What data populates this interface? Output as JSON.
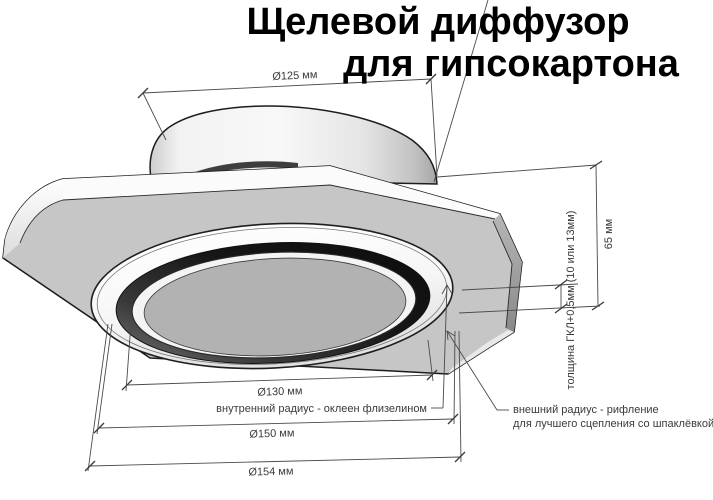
{
  "title": {
    "line1": "Щелевой диффузор",
    "line2": "для гипсокартона"
  },
  "dimensions": {
    "duct_diameter": "Ø125 мм",
    "height": "65 мм",
    "plate_thickness": "толщина ГКЛ+0,5мм (10 или 13мм)",
    "inner_diameter": "Ø130 мм",
    "outer_diameter": "Ø150 мм",
    "flange_diameter": "Ø154 мм"
  },
  "annotations": {
    "inner_radius": "внутренний радиус - оклеен флизелином",
    "outer_radius_line1": "внешний радиус - рифление",
    "outer_radius_line2": "для лучшего сцепления со шпаклёвкой"
  },
  "colors": {
    "background": "#ffffff",
    "plate_gray": "#c6c6c6",
    "disc_gray": "#b2b2b2",
    "slot_dark": "#1e1e1e",
    "outline": "#1c1c1c",
    "dim_line": "#4a4a4a",
    "dim_text": "#3a3a3a",
    "title_text": "#000000"
  }
}
